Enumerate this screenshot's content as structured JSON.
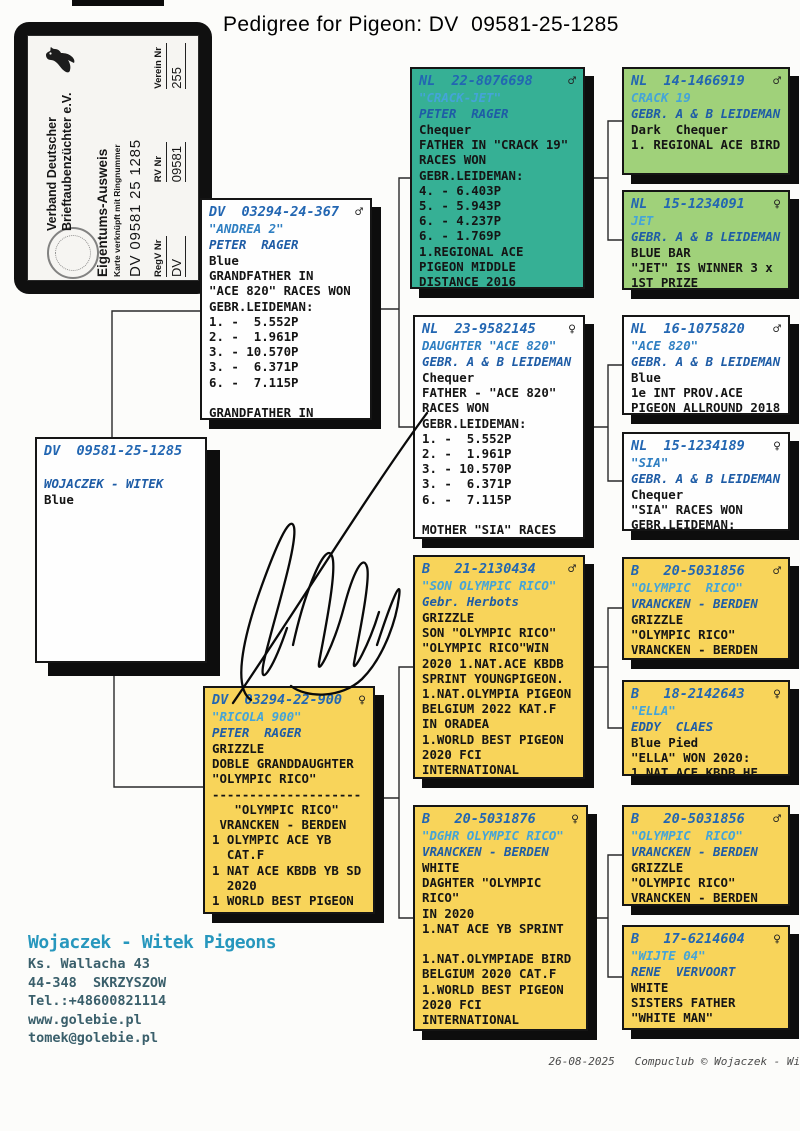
{
  "page": {
    "title": "Pedigree for Pigeon: DV  09581-25-1285"
  },
  "card": {
    "club_line1": "Verband Deutscher",
    "club_line2": "Brieftaubenzüchter e.V.",
    "doc_title": "Eigentums-Ausweis",
    "subtitle": "Karte verknüpft mit Ringnummer",
    "ring": "DV 09581 25 1285",
    "fields": [
      {
        "label": "RegV Nr",
        "value": "DV"
      },
      {
        "label": "RV Nr",
        "value": "09581"
      },
      {
        "label": "Verein Nr",
        "value": "255"
      }
    ]
  },
  "symbols": {
    "male": "♂",
    "female": "♀"
  },
  "colors": {
    "teal_box": "#36b095",
    "green_box": "#a0d17a",
    "yellow_box": "#f8d45a",
    "ring_blue": "#2266b2",
    "name_blue": "#44a4d8",
    "owner_blue": "#1e5ca6",
    "contact_teal": "#2797bd"
  },
  "boxes": {
    "subject": {
      "ring": "DV  09581-25-1285",
      "sex": "",
      "name": "",
      "owner": "WOJACZEK - WITEK",
      "lines": [
        "Blue"
      ]
    },
    "father": {
      "ring": "DV  03294-24-367",
      "sex": "♂",
      "name": "\"ANDREA 2\"",
      "owner": "PETER  RAGER",
      "lines": [
        "Blue",
        "GRANDFATHER IN",
        "\"ACE 820\" RACES WON",
        "GEBR.LEIDEMAN:",
        "1. -  5.552P",
        "2. -  1.961P",
        "3. - 10.570P",
        "3. -  6.371P",
        "6. -  7.115P",
        "",
        "GRANDFATHER IN"
      ]
    },
    "mother": {
      "ring": "DV  03294-22-900",
      "sex": "♀",
      "name": "\"RICOLA 900\"",
      "owner": "PETER  RAGER",
      "lines": [
        "GRIZZLE",
        "DOBLE GRANDDAUGHTER",
        "\"OLYMPIC RICO\"",
        "--------------------",
        "   \"OLYMPIC RICO\"",
        " VRANCKEN - BERDEN",
        "1 OLYMPIC ACE YB",
        "  CAT.F",
        "1 NAT ACE KBDB YB SD",
        "  2020",
        "1 WORLD BEST PIGEON"
      ]
    },
    "pgf": {
      "ring": "NL  22-8076698",
      "sex": "♂",
      "name": "\"CRACK-JET\"",
      "owner": "PETER  RAGER",
      "lines": [
        "Chequer",
        "FATHER IN \"CRACK 19\"",
        "RACES WON",
        "GEBR.LEIDEMAN:",
        "4. - 6.403P",
        "5. - 5.943P",
        "6. - 4.237P",
        "6. - 1.769P",
        "1.REGIONAL ACE",
        "PIGEON MIDDLE",
        "DISTANCE 2016"
      ]
    },
    "pgm": {
      "ring": "NL  23-9582145",
      "sex": "♀",
      "name": "DAUGHTER \"ACE 820\"",
      "owner": "GEBR. A & B LEIDEMAN",
      "lines": [
        "Chequer",
        "FATHER - \"ACE 820\"",
        "RACES WON",
        "GEBR.LEIDEMAN:",
        "1. -  5.552P",
        "2. -  1.961P",
        "3. - 10.570P",
        "3. -  6.371P",
        "6. -  7.115P",
        "",
        "MOTHER \"SIA\" RACES"
      ]
    },
    "mgf": {
      "ring": "B   21-2130434",
      "sex": "♂",
      "name": "\"SON OLYMPIC RICO\"",
      "owner": "Gebr. Herbots",
      "lines": [
        "GRIZZLE",
        "SON \"OLYMPIC RICO\"",
        "\"OLYMPIC RICO\"WIN",
        "2020 1.NAT.ACE KBDB",
        "SPRINT YOUNGPIGEON.",
        "1.NAT.OLYMPIA PIGEON",
        "BELGIUM 2022 KAT.F",
        "IN ORADEA",
        "1.WORLD BEST PIGEON",
        "2020 FCI",
        "INTERNATIONAL"
      ]
    },
    "mgm": {
      "ring": "B   20-5031876",
      "sex": "♀",
      "name": "\"DGHR OLYMPIC RICO\"",
      "owner": "VRANCKEN - BERDEN",
      "lines": [
        "WHITE",
        "DAGHTER \"OLYMPIC",
        "RICO\"",
        "IN 2020",
        "1.NAT ACE YB SPRINT",
        "",
        "1.NAT.OLYMPIADE BIRD",
        "BELGIUM 2020 CAT.F",
        "1.WORLD BEST PIGEON",
        "2020 FCI",
        "INTERNATIONAL"
      ]
    },
    "pgf_f": {
      "ring": "NL  14-1466919",
      "sex": "♂",
      "name": "CRACK 19",
      "owner": "GEBR. A & B LEIDEMAN",
      "lines": [
        "Dark  Chequer",
        "1. REGIONAL ACE BIRD"
      ]
    },
    "pgf_m": {
      "ring": "NL  15-1234091",
      "sex": "♀",
      "name": "JET",
      "owner": "GEBR. A & B LEIDEMAN",
      "lines": [
        "BLUE BAR",
        "\"JET\" IS WINNER 3 x",
        "1ST PRIZE"
      ]
    },
    "pgm_f": {
      "ring": "NL  16-1075820",
      "sex": "♂",
      "name": "\"ACE 820\"",
      "owner": "GEBR. A & B LEIDEMAN",
      "lines": [
        "Blue",
        "1e INT PROV.ACE",
        "PIGEON ALLROUND 2018"
      ]
    },
    "pgm_m": {
      "ring": "NL  15-1234189",
      "sex": "♀",
      "name": "\"SIA\"",
      "owner": "GEBR. A & B LEIDEMAN",
      "lines": [
        "Chequer",
        "\"SIA\" RACES WON",
        "GEBR.LEIDEMAN:"
      ]
    },
    "mgf_f": {
      "ring": "B   20-5031856",
      "sex": "♂",
      "name": "\"OLYMPIC  RICO\"",
      "owner": "VRANCKEN - BERDEN",
      "lines": [
        "GRIZZLE",
        "\"OLYMPIC RICO\"",
        "VRANCKEN - BERDEN"
      ]
    },
    "mgf_m": {
      "ring": "B   18-2142643",
      "sex": "♀",
      "name": "\"ELLA\"",
      "owner": "EDDY  CLAES",
      "lines": [
        "Blue Pied",
        "\"ELLA\" WON 2020:",
        "1.NAT.ACE KBDB HF"
      ]
    },
    "mgm_f": {
      "ring": "B   20-5031856",
      "sex": "♂",
      "name": "\"OLYMPIC  RICO\"",
      "owner": "VRANCKEN - BERDEN",
      "lines": [
        "GRIZZLE",
        "\"OLYMPIC RICO\"",
        "VRANCKEN - BERDEN"
      ]
    },
    "mgm_m": {
      "ring": "B   17-6214604",
      "sex": "♀",
      "name": "\"WIJTE 04\"",
      "owner": "RENE  VERVOORT",
      "lines": [
        "WHITE",
        "SISTERS FATHER",
        "\"WHITE MAN\""
      ]
    }
  },
  "contact": {
    "name": "Wojaczek - Witek Pigeons",
    "lines": [
      "Ks. Wallacha 43",
      "44-348  SKRZYSZOW",
      "Tel.:+48600821114",
      "www.golebie.pl",
      "tomek@golebie.pl"
    ]
  },
  "footer": {
    "date": "26-08-2025",
    "credit": "Compuclub © Wojaczek - Witek Pigeons"
  }
}
